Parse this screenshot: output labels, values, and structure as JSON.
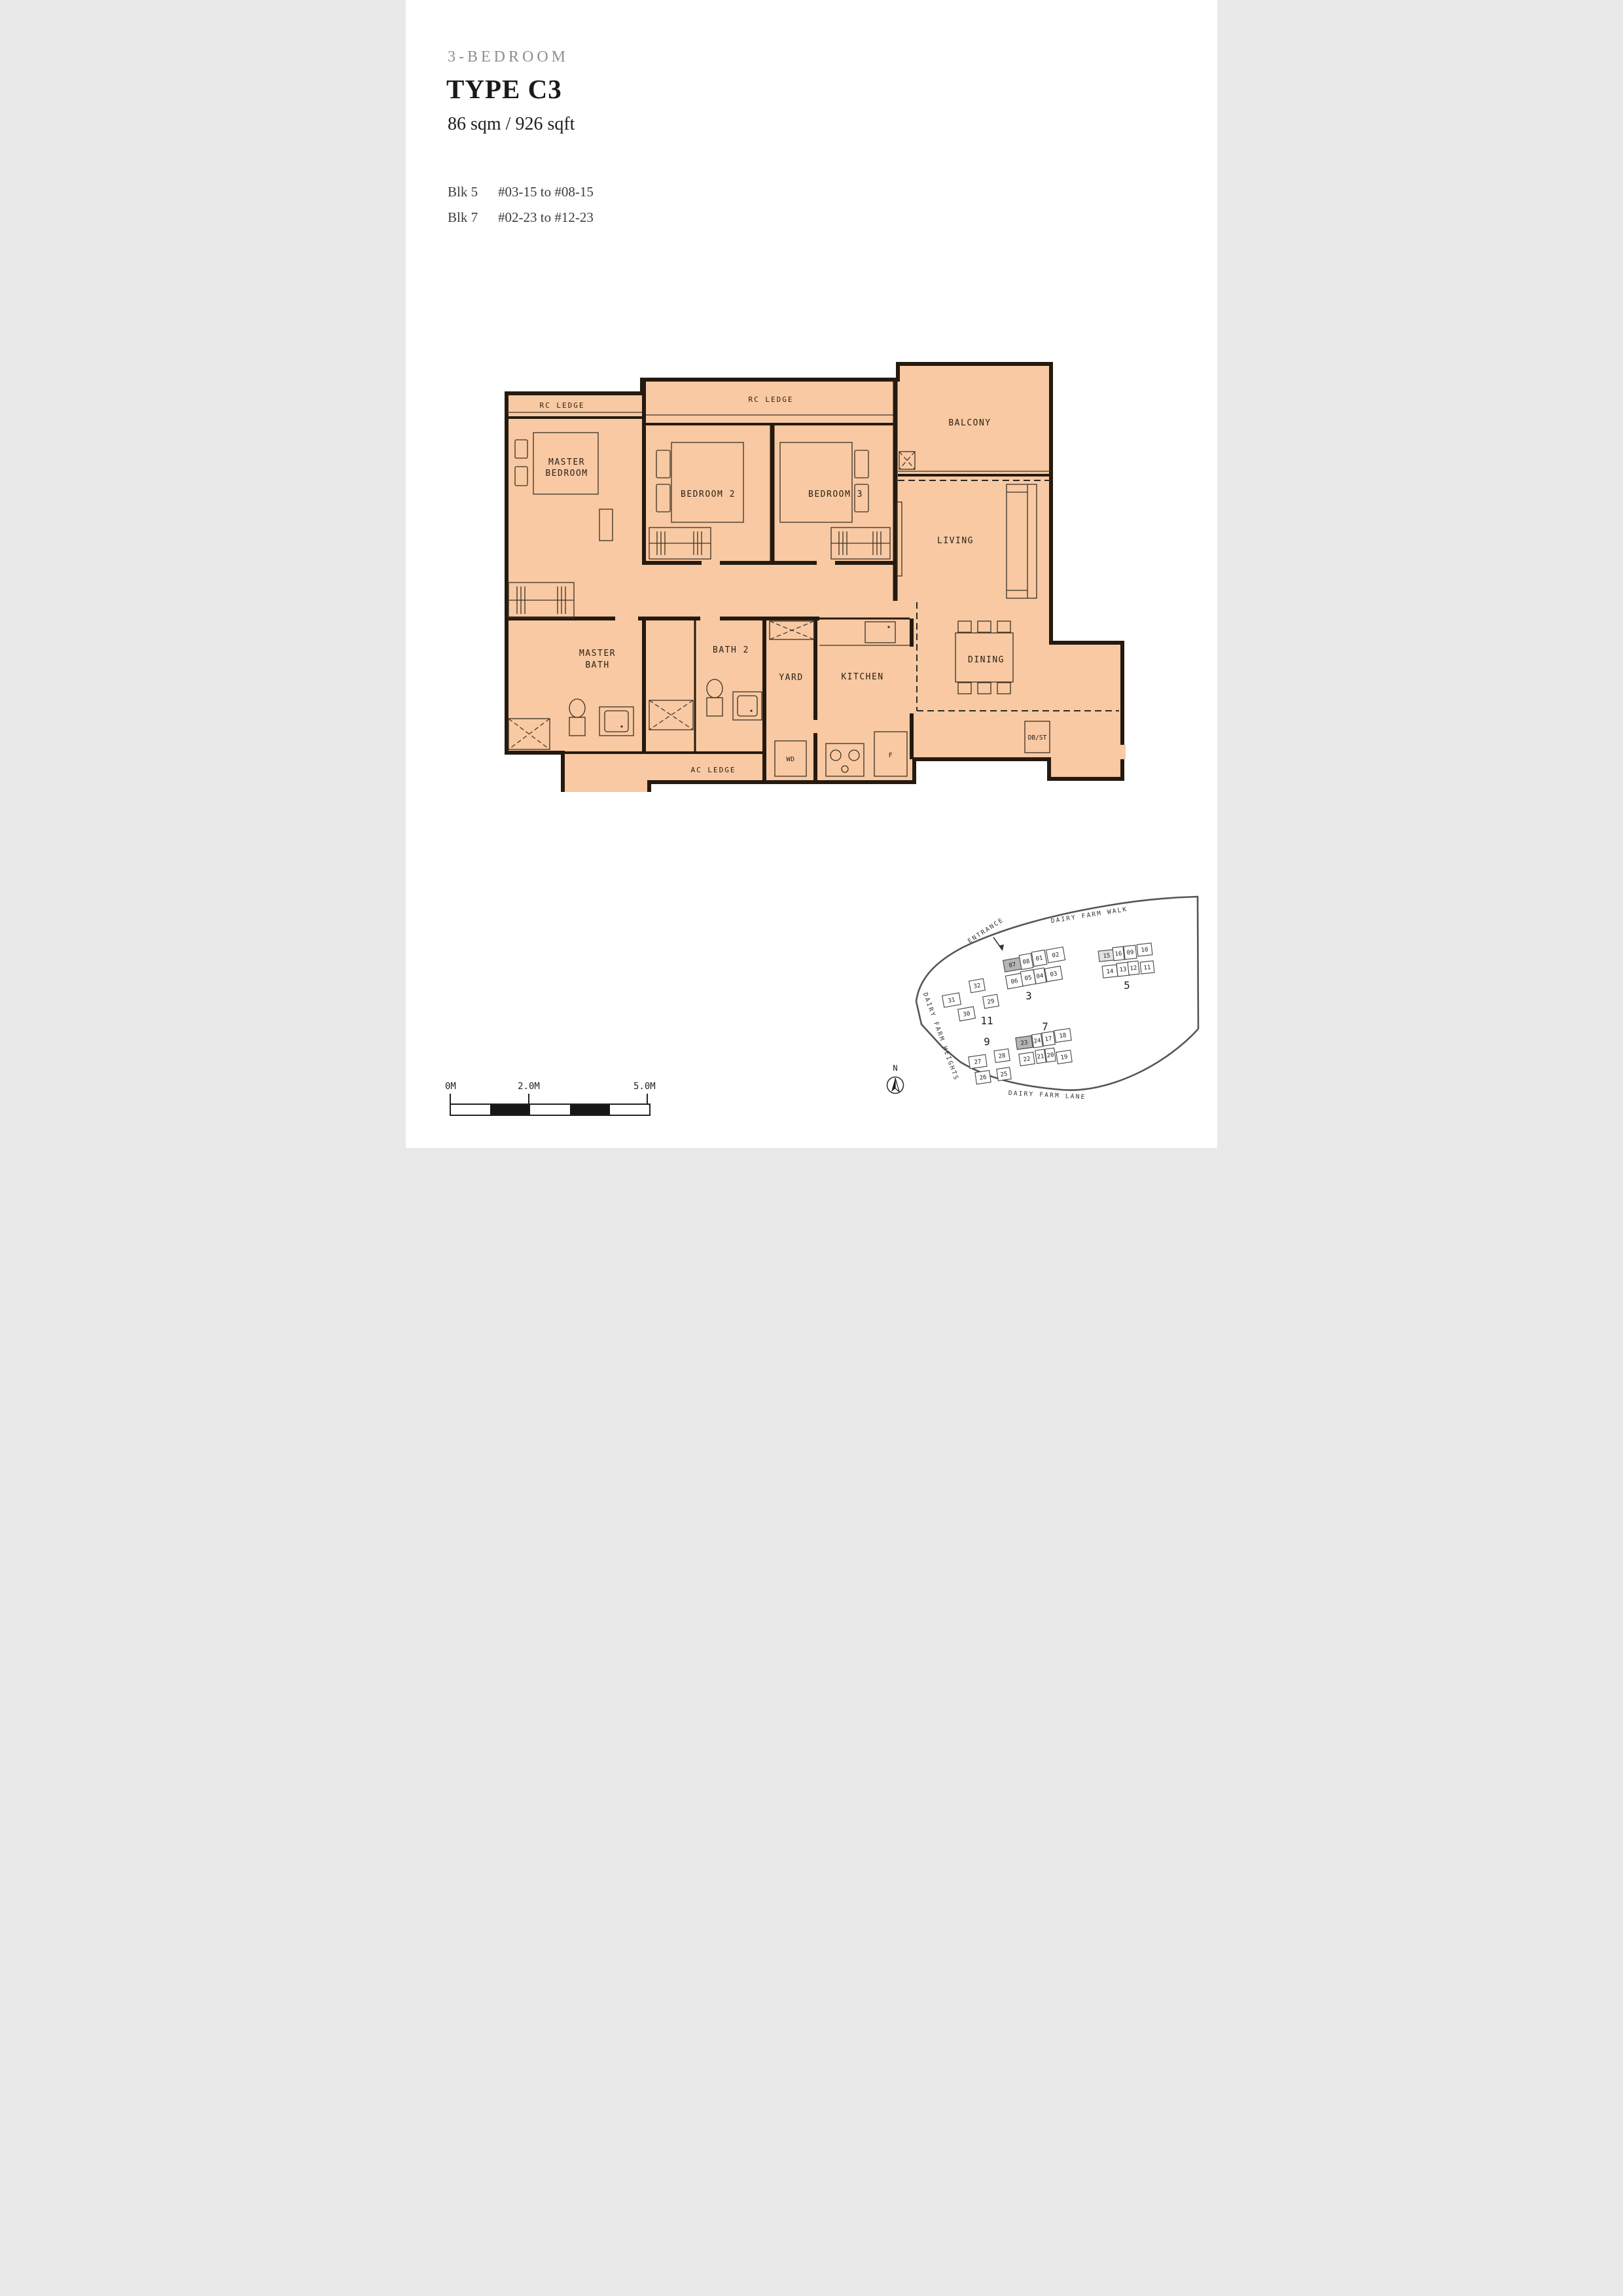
{
  "header": {
    "category": "3-BEDROOM",
    "type_name": "TYPE C3",
    "area": "86 sqm / 926 sqft",
    "availability": [
      {
        "blk": "Blk 5",
        "units": "#03-15 to #08-15"
      },
      {
        "blk": "Blk 7",
        "units": "#02-23 to #12-23"
      }
    ]
  },
  "floorplan": {
    "labels": {
      "rc_ledge_master": "RC LEDGE",
      "rc_ledge_bedrooms": "RC LEDGE",
      "balcony": "BALCONY",
      "master_bedroom_l1": "MASTER",
      "master_bedroom_l2": "BEDROOM",
      "bedroom2": "BEDROOM 2",
      "bedroom3": "BEDROOM 3",
      "living": "LIVING",
      "dining": "DINING",
      "master_bath_l1": "MASTER",
      "master_bath_l2": "BATH",
      "bath2": "BATH 2",
      "yard": "YARD",
      "kitchen": "KITCHEN",
      "wd": "WD",
      "fridge": "F",
      "ac_ledge": "AC LEDGE",
      "db_st": "DB/ST"
    }
  },
  "sitemap": {
    "roads": {
      "walk": "DAIRY FARM WALK",
      "heights": "DAIRY FARM HEIGHTS",
      "lane": "DAIRY FARM LANE"
    },
    "entrance": "ENTRANCE",
    "north": "N",
    "blocks": [
      {
        "label": "3",
        "units": [
          {
            "no": "07"
          },
          {
            "no": "08"
          },
          {
            "no": "01"
          },
          {
            "no": "02"
          },
          {
            "no": "06"
          },
          {
            "no": "05"
          },
          {
            "no": "04"
          },
          {
            "no": "03"
          }
        ]
      },
      {
        "label": "5",
        "units": [
          {
            "no": "15"
          },
          {
            "no": "16"
          },
          {
            "no": "09"
          },
          {
            "no": "10"
          },
          {
            "no": "14"
          },
          {
            "no": "13"
          },
          {
            "no": "12"
          },
          {
            "no": "11"
          }
        ]
      },
      {
        "label": "11",
        "units": [
          {
            "no": "31"
          },
          {
            "no": "32"
          },
          {
            "no": "29"
          },
          {
            "no": "30"
          }
        ]
      },
      {
        "label": "9",
        "units": [
          {
            "no": "27"
          },
          {
            "no": "28"
          },
          {
            "no": "26"
          },
          {
            "no": "25"
          }
        ]
      },
      {
        "label": "7",
        "units": [
          {
            "no": "23"
          },
          {
            "no": "24"
          },
          {
            "no": "17"
          },
          {
            "no": "18"
          },
          {
            "no": "22"
          },
          {
            "no": "21"
          },
          {
            "no": "20"
          },
          {
            "no": "19"
          }
        ]
      }
    ]
  },
  "scalebar": {
    "ticks": [
      "0M",
      "2.0M",
      "5.0M"
    ]
  },
  "colors": {
    "plan_fill": "#f8c9a2",
    "wall": "#241a10",
    "unit_highlight": "#b5b5b5",
    "unit_highlight_light": "#e3e3e3",
    "boundary": "#565656"
  }
}
